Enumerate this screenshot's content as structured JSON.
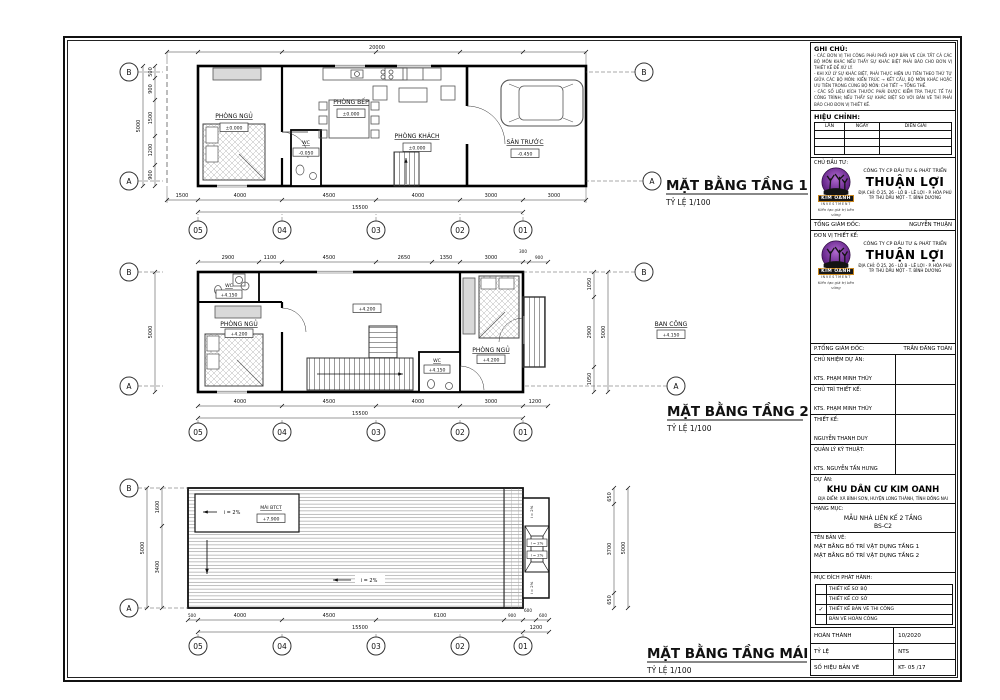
{
  "sheet": {
    "grid": {
      "cols": [
        "05",
        "04",
        "03",
        "02",
        "01"
      ],
      "row_a": "A",
      "row_b": "B"
    },
    "plan1": {
      "title": "MẶT BẰNG TẦNG 1",
      "scale": "TỶ LỆ 1/100",
      "rooms": {
        "ngu": {
          "name": "PHÒNG NGỦ",
          "level": "±0.000"
        },
        "wc": {
          "name": "WC",
          "level": "-0.050"
        },
        "bep": {
          "name": "PHÒNG BẾP",
          "level": "±0.000"
        },
        "khach": {
          "name": "PHÒNG KHÁCH",
          "level": "±0.000"
        },
        "san": {
          "name": "SÂN TRƯỚC",
          "level": "-0.450"
        }
      },
      "dims": {
        "top_total": "20000",
        "bottom": [
          "1500",
          "4000",
          "4500",
          "4000",
          "3000",
          "3000"
        ],
        "bottom_total": "15500",
        "left": [
          "500",
          "900",
          "1500",
          "1200",
          "900"
        ],
        "left_total": "5000"
      }
    },
    "plan2": {
      "title": "MẶT BẰNG TẦNG 2",
      "scale": "TỶ LỆ 1/100",
      "rooms": {
        "wc1": {
          "name": "WC",
          "level": "+4.150"
        },
        "ngu1": {
          "name": "PHÒNG NGỦ",
          "level": "+4.200"
        },
        "hall_level": "+4.200",
        "wc2": {
          "name": "WC",
          "level": "+4.150"
        },
        "ngu2": {
          "name": "PHÒNG NGỦ",
          "level": "+4.200"
        },
        "bancong": {
          "name": "BAN CÔNG",
          "level": "+4.150"
        }
      },
      "dims": {
        "top": [
          "2900",
          "1100",
          "4500",
          "2650",
          "1350",
          "3000",
          "300",
          "900"
        ],
        "bottom": [
          "4000",
          "4500",
          "4000",
          "3000"
        ],
        "balcony": "1200",
        "bottom_total": "15500",
        "right": [
          "1050",
          "2900",
          "1050"
        ],
        "right_total": "5000",
        "left_total": "5000"
      }
    },
    "roof": {
      "title": "MẶT BẰNG TẦNG MÁI",
      "scale": "TỶ LỆ 1/100",
      "labels": {
        "mai": "MÁI BTCT",
        "mai_level": "+7.900",
        "slope": "i = 2%"
      },
      "dims": {
        "bottom": [
          "500",
          "4000",
          "4500",
          "6100",
          "900",
          "600",
          "600"
        ],
        "bottom_total": "15500",
        "right_ext": "1200",
        "left": [
          "1600",
          "3400"
        ],
        "left_total": "5000",
        "right": [
          "650",
          "3700",
          "650"
        ],
        "right_total": "5000"
      }
    }
  },
  "titleblock": {
    "notes": {
      "heading": "GHI CHÚ:",
      "lines": [
        "- CÁC ĐƠN VỊ THI CÔNG PHẢI PHỐI HỢP BẢN VẼ CỦA TẤT CẢ CÁC BỘ MÔN KHÁC NẾU THẤY SỰ KHÁC BIỆT PHẢI BÁO CHO ĐƠN VỊ THIẾT KẾ ĐỂ XỬ LÝ.",
        "- KHI XỬ LÝ SỰ KHÁC BIỆT, PHẢI THỰC HIỆN ƯU TIÊN THEO THỨ TỰ GIỮA CÁC BỘ MÔN: KIẾN TRÚC → KẾT CẤU, BỘ MÔN KHÁC HOẶC ƯU TIÊN TRONG CÙNG BỘ MÔN: CHI TIẾT → TỔNG THỂ.",
        "- CÁC SỐ LIỆU KÍCH THƯỚC PHẢI ĐƯỢC KIỂM TRA THỰC TẾ TẠI CÔNG TRÌNH; NẾU THẤY SỰ KHÁC BIỆT SO VỚI BẢN VẼ THÌ PHẢI BÁO CHO ĐƠN VỊ THIẾT KẾ."
      ]
    },
    "revision": {
      "heading": "HIỆU CHỈNH:",
      "col_lan": "LẦN",
      "col_ngay": "NGÀY",
      "col_dien_giai": "DIỄN GIẢI"
    },
    "investor_label": "CHỦ ĐẦU TƯ:",
    "designer_label": "ĐƠN VỊ THIẾT KẾ:",
    "company": {
      "line1": "CÔNG TY CP ĐẦU TƯ & PHÁT TRIỂN",
      "name": "THUẬN LỢI",
      "addr1": "ĐỊA CHỈ: Ô 25, 26 - LÔ B - LÊ LỢI - P. HÒA PHÚ",
      "addr2": "TP. THỦ DẦU MỘT - T. BÌNH DƯƠNG"
    },
    "logo": {
      "name": "KIM OANH",
      "sub": "INVESTMENT",
      "tagline": "Kiến tạo giá trị bền vững"
    },
    "director": {
      "label": "TỔNG GIÁM ĐỐC:",
      "value": "NGUYỄN THUẬN"
    },
    "deputy": {
      "label": "P.TỔNG GIÁM ĐỐC:",
      "value": "TRẦN ĐĂNG TOÀN"
    },
    "roles": [
      {
        "label": "CHỦ NHIỆM DỰ ÁN:",
        "value": "KTS. PHẠM MINH THÚY"
      },
      {
        "label": "CHỦ TRÌ THIẾT KẾ:",
        "value": "KTS. PHẠM MINH THÚY"
      },
      {
        "label": "THIẾT KẾ:",
        "value": "NGUYỄN THANH DUY"
      },
      {
        "label": "QUẢN LÝ KỸ THUẬT:",
        "value": "KTS. NGUYỄN TẤN HƯNG"
      }
    ],
    "project": {
      "label": "DỰ ÁN:",
      "name": "KHU DÂN CƯ KIM OANH",
      "location": "ĐỊA ĐIỂM: XÃ BÌNH SƠN, HUYỆN LONG THÀNH, TỈNH ĐỒNG NAI"
    },
    "category": {
      "label": "HẠNG MỤC:",
      "line1": "MẪU NHÀ LIÊN KẾ 2 TẦNG",
      "line2": "BS-C2"
    },
    "drawing": {
      "label": "TÊN BẢN VẼ:",
      "line1": "MẶT BẰNG BỐ TRÍ VẬT DỤNG TẦNG 1",
      "line2": "MẶT BẰNG BỐ TRÍ VẬT DỤNG TẦNG 2"
    },
    "issue": {
      "label": "MỤC ĐÍCH PHÁT HÀNH:",
      "options": [
        {
          "text": "THIẾT KẾ SƠ BỘ",
          "mark": ""
        },
        {
          "text": "THIẾT KẾ CƠ SỞ",
          "mark": ""
        },
        {
          "text": "THIẾT KẾ BẢN VẼ THI CÔNG",
          "mark": "✓"
        },
        {
          "text": "BẢN VẼ HOÀN CÔNG",
          "mark": ""
        }
      ]
    },
    "footer": {
      "done_label": "HOÀN THÀNH",
      "done_value": "10/2020",
      "scale_label": "TỶ LỆ",
      "scale_value": "NTS",
      "number_label": "SỐ HIỆU BẢN VẼ",
      "number_value": "KT- 05 /17"
    }
  }
}
